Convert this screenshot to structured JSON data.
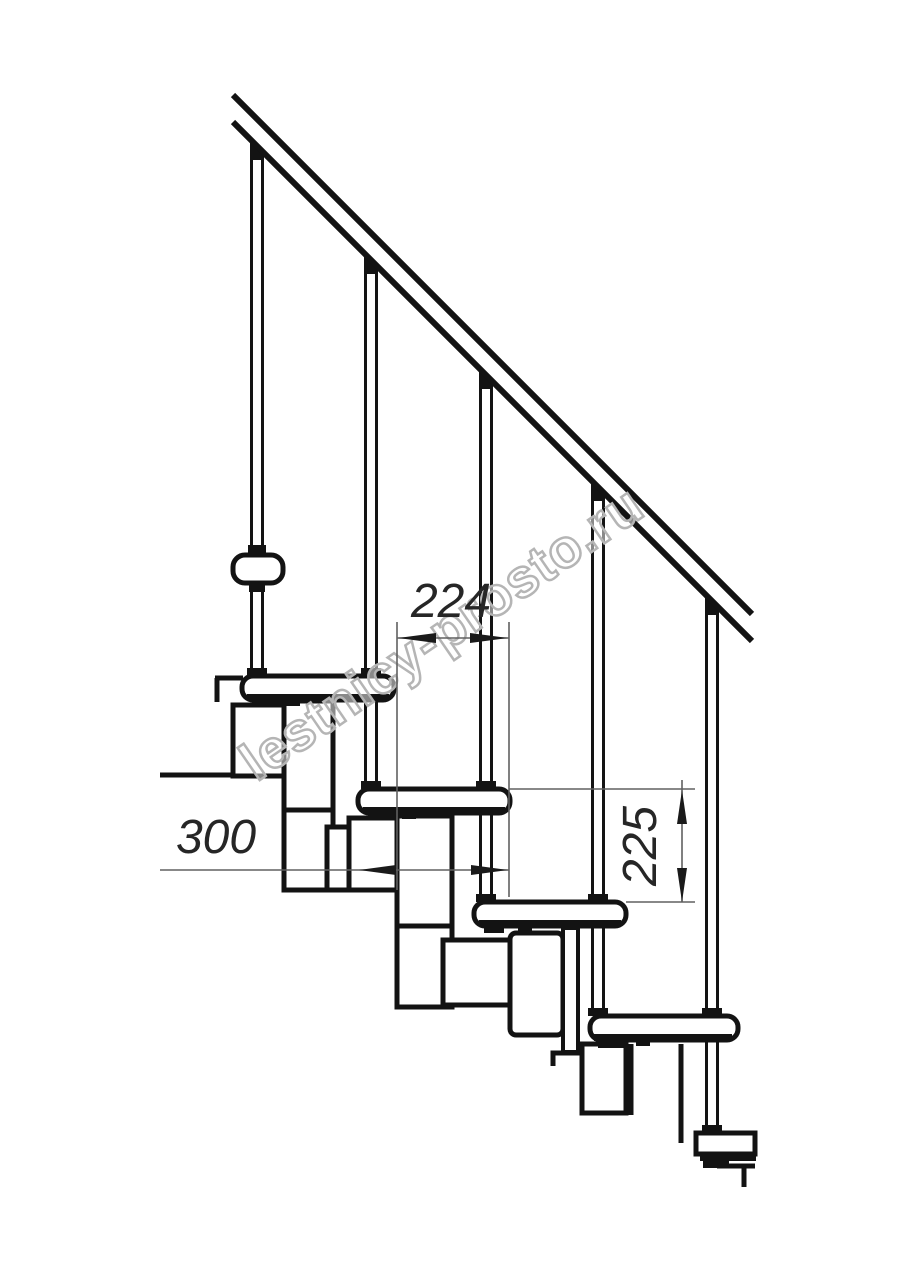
{
  "drawing": {
    "title": "modular staircase side elevation",
    "watermark": "lestnicy-prosto.ru",
    "dimensions": {
      "step_run": "224",
      "tread_depth": "300",
      "step_rise": "225"
    },
    "colors": {
      "line": "#131313",
      "dimension": "#606060",
      "watermark_outline": "#b5b5b5",
      "background": "#ffffff"
    }
  }
}
